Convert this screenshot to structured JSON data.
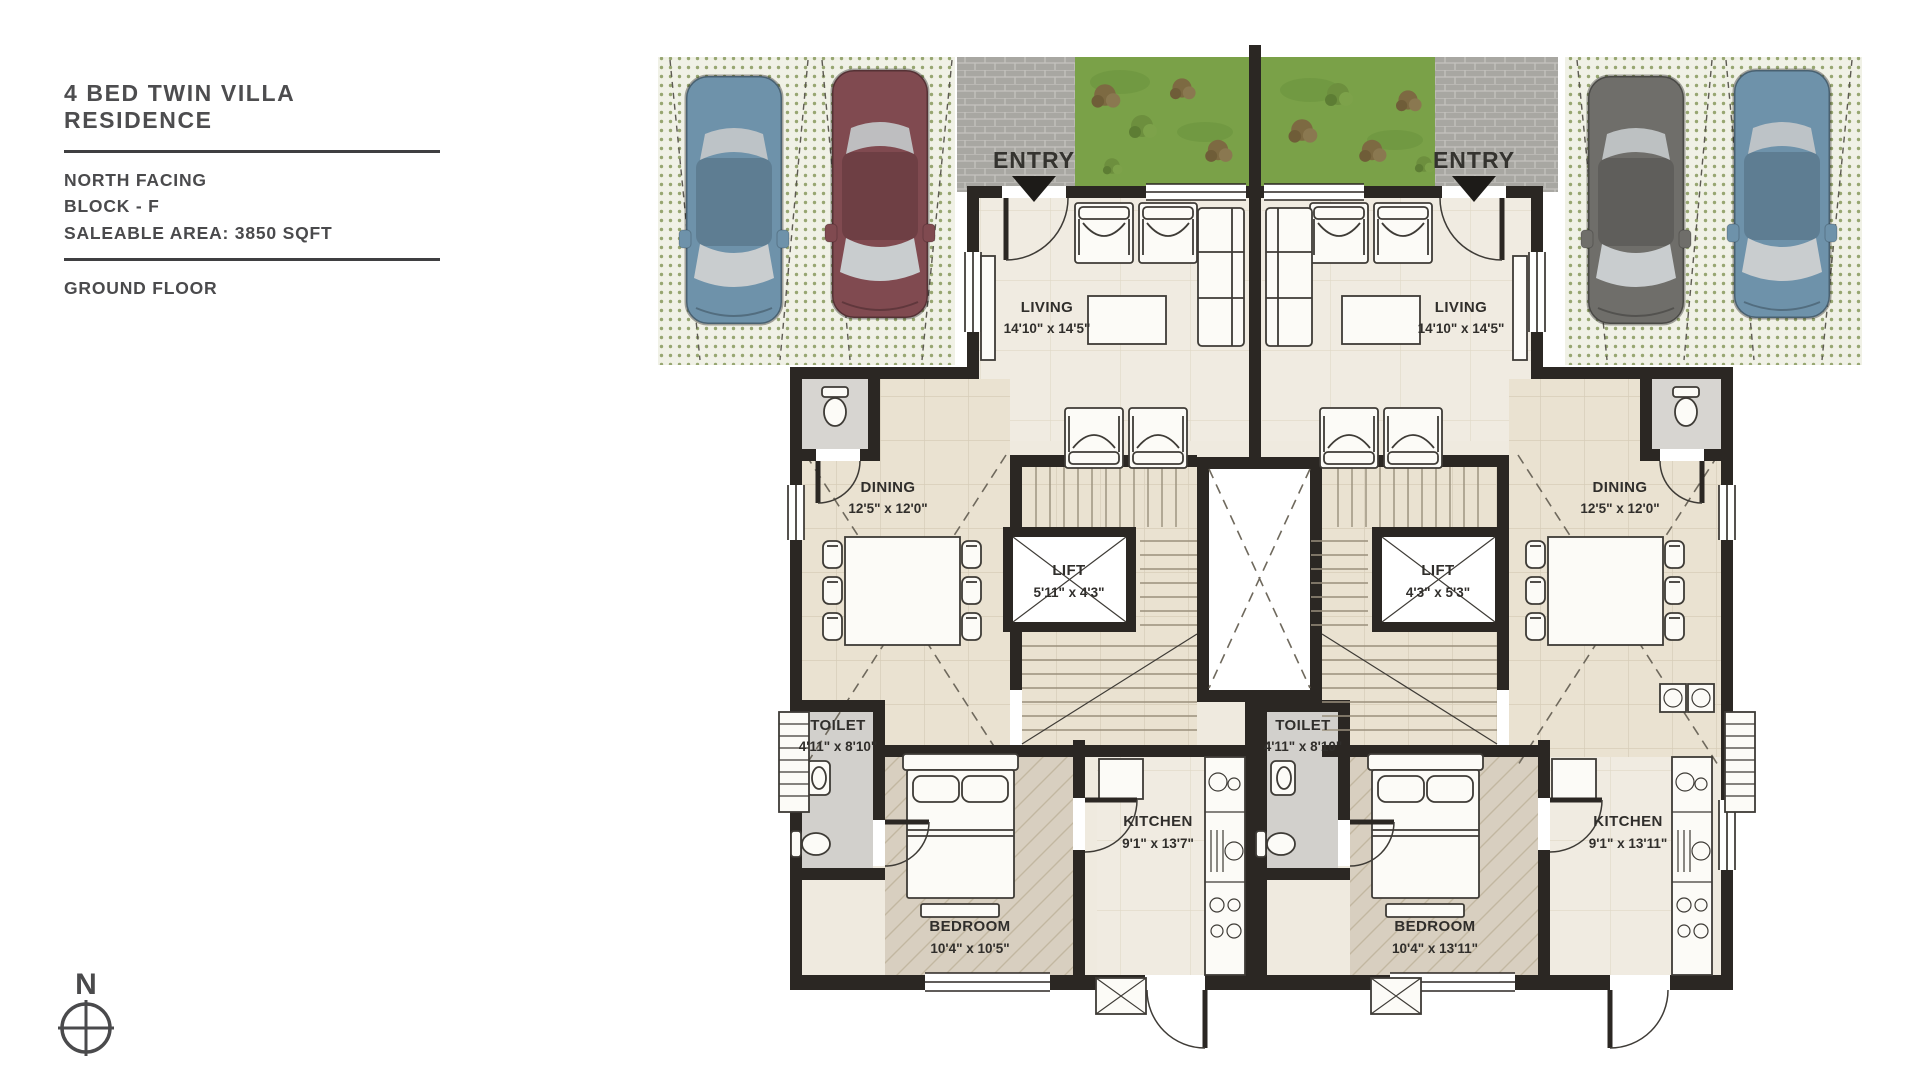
{
  "panel": {
    "title": "4 BED TWIN VILLA RESIDENCE",
    "facing": "NORTH FACING",
    "block": "BLOCK - F",
    "saleable_area": "SALEABLE AREA: 3850 SQFT",
    "floor": "GROUND FLOOR"
  },
  "compass": {
    "north_label": "N"
  },
  "plan": {
    "entries": {
      "left": "ENTRY",
      "right": "ENTRY"
    },
    "units": {
      "left": {
        "living": {
          "name": "LIVING",
          "dims": "14'10\" x 14'5\""
        },
        "dining": {
          "name": "DINING",
          "dims": "12'5\" x 12'0\""
        },
        "lift": {
          "name": "LIFT",
          "dims": "5'11\" x 4'3\""
        },
        "toilet": {
          "name": "TOILET",
          "dims": "4'11\" x 8'10\""
        },
        "kitchen": {
          "name": "KITCHEN",
          "dims": "9'1\" x 13'7\""
        },
        "bedroom": {
          "name": "BEDROOM",
          "dims": "10'4\" x 10'5\""
        }
      },
      "right": {
        "living": {
          "name": "LIVING",
          "dims": "14'10\" x 14'5\""
        },
        "dining": {
          "name": "DINING",
          "dims": "12'5\" x 12'0\""
        },
        "lift": {
          "name": "LIFT",
          "dims": "4'3\" x 5'3\""
        },
        "toilet": {
          "name": "TOILET",
          "dims": "4'11\" x 8'10\""
        },
        "kitchen": {
          "name": "KITCHEN",
          "dims": "9'1\" x 13'11\""
        },
        "bedroom": {
          "name": "BEDROOM",
          "dims": "10'4\" x 13'11\""
        }
      }
    },
    "colors": {
      "wall": "#2b2723",
      "floor_base": "#efeadf",
      "floor_tile": "#eae2d1",
      "floor_bedroom": "#d8cfc0",
      "floor_toilet": "#d2d0cc",
      "lawn": "#7aa148",
      "paver": "#a8a7a2",
      "parking_hatch": "#97a671",
      "car_blue": "#6e92aa",
      "car_maroon": "#804a50",
      "car_grey": "#6f6e6a",
      "text": "#4a4a4c"
    }
  }
}
